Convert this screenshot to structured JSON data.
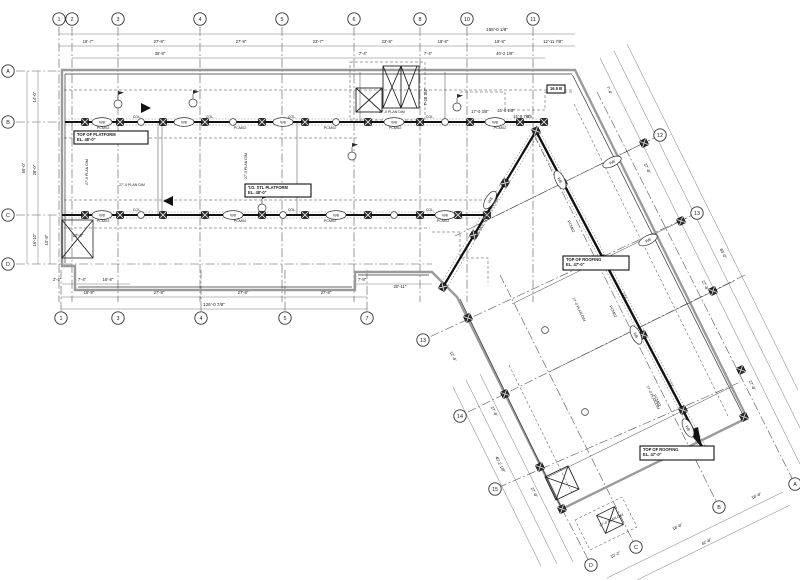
{
  "meta": {
    "drawing_type": "structural-framing-plan",
    "bg": "#ffffff",
    "ink": "#1c1c1c",
    "wall_gray": "#9a9a9a",
    "grid_line": "#555555",
    "dim_line": "#777777"
  },
  "grid": {
    "top": [
      {
        "label": "1",
        "x": 59
      },
      {
        "label": "2",
        "x": 72
      },
      {
        "label": "3",
        "x": 118
      },
      {
        "label": "4",
        "x": 200
      },
      {
        "label": "5",
        "x": 282
      },
      {
        "label": "6",
        "x": 354
      },
      {
        "label": "8",
        "x": 420
      },
      {
        "label": "10",
        "x": 467
      },
      {
        "label": "11",
        "x": 533
      }
    ],
    "bottom": [
      {
        "label": "1",
        "x": 61
      },
      {
        "label": "3",
        "x": 118
      },
      {
        "label": "4",
        "x": 201
      },
      {
        "label": "5",
        "x": 285
      },
      {
        "label": "7",
        "x": 367
      }
    ],
    "left": [
      {
        "label": "A",
        "y": 71
      },
      {
        "label": "B",
        "y": 122
      },
      {
        "label": "C",
        "y": 215
      },
      {
        "label": "D",
        "y": 264
      }
    ],
    "wing_right": [
      {
        "label": "12",
        "x": 660,
        "y": 135
      },
      {
        "label": "13",
        "x": 697,
        "y": 213
      }
    ],
    "wing_left": [
      {
        "label": "13",
        "x": 423,
        "y": 340
      },
      {
        "label": "14",
        "x": 460,
        "y": 416
      },
      {
        "label": "15",
        "x": 495,
        "y": 489
      }
    ],
    "wing_end": [
      {
        "label": "A",
        "x": 795,
        "y": 484
      },
      {
        "label": "B",
        "x": 719,
        "y": 507
      },
      {
        "label": "C",
        "x": 636,
        "y": 547
      },
      {
        "label": "D",
        "x": 591,
        "y": 565
      }
    ]
  },
  "dimensions": [
    {
      "t": "168'-0 1/8\"",
      "x": 497,
      "y": 31,
      "r": 0,
      "s": 4.6
    },
    {
      "t": "18'-7\"",
      "x": 88,
      "y": 43,
      "r": 0
    },
    {
      "t": "27'-8\"",
      "x": 159,
      "y": 43,
      "r": 0
    },
    {
      "t": "27'-8\"",
      "x": 241,
      "y": 43,
      "r": 0
    },
    {
      "t": "23'-7\"",
      "x": 318,
      "y": 43,
      "r": 0
    },
    {
      "t": "22'-8\"",
      "x": 387,
      "y": 43,
      "r": 0
    },
    {
      "t": "18'-8\"",
      "x": 443,
      "y": 43,
      "r": 0
    },
    {
      "t": "18'-8\"",
      "x": 500,
      "y": 43,
      "r": 0
    },
    {
      "t": "12'-11 7/8\"",
      "x": 553,
      "y": 43,
      "r": 0
    },
    {
      "t": "36'-8\"",
      "x": 160,
      "y": 55,
      "r": 0
    },
    {
      "t": "7'-4\"",
      "x": 363,
      "y": 55,
      "r": 0
    },
    {
      "t": "7'-4\"",
      "x": 428,
      "y": 55,
      "r": 0
    },
    {
      "t": "40'-2 1/8\"",
      "x": 505,
      "y": 55,
      "r": 0
    },
    {
      "t": "18'-8\"",
      "x": 89,
      "y": 294,
      "r": 0
    },
    {
      "t": "27'-8\"",
      "x": 159,
      "y": 294,
      "r": 0
    },
    {
      "t": "27'-8\"",
      "x": 243,
      "y": 294,
      "r": 0
    },
    {
      "t": "27'-8\"",
      "x": 326,
      "y": 294,
      "r": 0
    },
    {
      "t": "126'-0 7/8\"",
      "x": 214,
      "y": 306,
      "r": 0,
      "s": 4.6
    },
    {
      "t": "2'-4\"",
      "x": 57,
      "y": 281,
      "r": 0
    },
    {
      "t": "7'-4\"",
      "x": 82,
      "y": 281,
      "r": 0
    },
    {
      "t": "16'-8\"",
      "x": 108,
      "y": 281,
      "r": 0
    },
    {
      "t": "7'-8\"",
      "x": 362,
      "y": 281,
      "r": 0
    },
    {
      "t": "20'-11\"",
      "x": 400,
      "y": 288,
      "r": 0
    },
    {
      "t": "56'-0\"",
      "x": 25,
      "y": 168,
      "r": -90
    },
    {
      "t": "14'-0\"",
      "x": 36,
      "y": 97,
      "r": -90
    },
    {
      "t": "28'-0\"",
      "x": 36,
      "y": 170,
      "r": -90
    },
    {
      "t": "16'-10\"",
      "x": 36,
      "y": 240,
      "r": -90
    },
    {
      "t": "10'-8\"",
      "x": 48,
      "y": 240,
      "r": -90
    },
    {
      "t": "27'-8\"",
      "x": 646,
      "y": 169,
      "r": 64
    },
    {
      "t": "27'-8\"",
      "x": 704,
      "y": 286,
      "r": 64
    },
    {
      "t": "27'-8\"",
      "x": 751,
      "y": 386,
      "r": 64
    },
    {
      "t": "83'-0\"",
      "x": 722,
      "y": 254,
      "r": 64
    },
    {
      "t": "7'-4\"",
      "x": 608,
      "y": 91,
      "r": 64
    },
    {
      "t": "27'-8\"",
      "x": 493,
      "y": 412,
      "r": 64
    },
    {
      "t": "27'-8\"",
      "x": 533,
      "y": 493,
      "r": 64
    },
    {
      "t": "40'-2 1/8\"",
      "x": 499,
      "y": 465,
      "r": 64
    },
    {
      "t": "12'-4\"",
      "x": 452,
      "y": 357,
      "r": 64
    },
    {
      "t": "18'-8\"",
      "x": 757,
      "y": 497,
      "r": -26
    },
    {
      "t": "18'-8\"",
      "x": 678,
      "y": 528,
      "r": -26
    },
    {
      "t": "10'-2\"",
      "x": 616,
      "y": 556,
      "r": -26
    },
    {
      "t": "42'-8\"",
      "x": 707,
      "y": 543,
      "r": -26
    },
    {
      "t": "15'-8 1/8\"",
      "x": 506,
      "y": 112,
      "r": 0
    },
    {
      "t": "15'-8 7/8\"",
      "x": 522,
      "y": 118,
      "r": 0
    },
    {
      "t": "10'-8\"",
      "x": 78,
      "y": 237,
      "r": 0
    },
    {
      "t": "7'-10 3/4\"",
      "x": 427,
      "y": 97,
      "r": -90
    },
    {
      "t": "17'-0 3/8\"",
      "x": 480,
      "y": 113,
      "r": 0
    }
  ],
  "plan_dims": [
    {
      "t": "27'-0 PLAN DIM",
      "x": 132,
      "y": 186,
      "r": 0
    },
    {
      "t": "27'-0 PLAN DIM",
      "x": 88,
      "y": 172,
      "r": -90
    },
    {
      "t": "27'-0 PLAN DIM",
      "x": 247,
      "y": 166,
      "r": -90
    },
    {
      "t": "27'-0 PLAN DIM",
      "x": 392,
      "y": 113,
      "r": 0
    },
    {
      "t": "27'-0 PLAN DIM",
      "x": 578,
      "y": 310,
      "r": 64
    },
    {
      "t": "27'-0 PLAN DIM",
      "x": 652,
      "y": 398,
      "r": 64
    },
    {
      "t": "27'-0 PLAN DIM",
      "x": 492,
      "y": 210,
      "r": -59
    },
    {
      "t": "27'-0 PLAN DIM",
      "x": 612,
      "y": 521,
      "r": -26
    }
  ],
  "notes": [
    {
      "lines": [
        "TOP OF PLATFORM",
        "EL. 48'-0\""
      ],
      "x": 74,
      "y": 131,
      "w": 74,
      "h": 13
    },
    {
      "lines": [
        "T.O. STL PLATFORM",
        "EL. 48'-0\""
      ],
      "x": 245,
      "y": 184,
      "w": 66,
      "h": 13
    },
    {
      "lines": [
        "TOP OF ROOFING",
        "EL. 47'-0\""
      ],
      "x": 563,
      "y": 256,
      "w": 66,
      "h": 14
    },
    {
      "lines": [
        "TOP OF ROOFING",
        "EL. 47'-0\""
      ],
      "x": 640,
      "y": 446,
      "w": 74,
      "h": 14
    },
    {
      "lines": [
        "16.5 B"
      ],
      "x": 547,
      "y": 85,
      "w": 18,
      "h": 8
    }
  ],
  "beam_labels": [
    {
      "t": "PCM02",
      "x": 103,
      "y": 129,
      "r": 0
    },
    {
      "t": "PCM02",
      "x": 240,
      "y": 129,
      "r": 0
    },
    {
      "t": "PCM02",
      "x": 330,
      "y": 129,
      "r": 0
    },
    {
      "t": "PCM02",
      "x": 395,
      "y": 129,
      "r": 0
    },
    {
      "t": "PCM02",
      "x": 500,
      "y": 129,
      "r": 0
    },
    {
      "t": "PCM02",
      "x": 103,
      "y": 222,
      "r": 0
    },
    {
      "t": "PCM02",
      "x": 240,
      "y": 222,
      "r": 0
    },
    {
      "t": "PCM02",
      "x": 330,
      "y": 222,
      "r": 0
    },
    {
      "t": "PCM02",
      "x": 443,
      "y": 222,
      "r": 0
    },
    {
      "t": "PCM02",
      "x": 570,
      "y": 227,
      "r": 64
    },
    {
      "t": "PCM02",
      "x": 612,
      "y": 312,
      "r": 64
    },
    {
      "t": "PCM02",
      "x": 656,
      "y": 401,
      "r": 64
    },
    {
      "t": "PCM02",
      "x": 481,
      "y": 230,
      "r": -59
    }
  ],
  "beam_tags": [
    {
      "t": "W8",
      "x": 102,
      "y": 122,
      "r": 0
    },
    {
      "t": "W8",
      "x": 184,
      "y": 122,
      "r": 0
    },
    {
      "t": "W8",
      "x": 283,
      "y": 122,
      "r": 0
    },
    {
      "t": "W8",
      "x": 394,
      "y": 122,
      "r": 0
    },
    {
      "t": "W8",
      "x": 495,
      "y": 122,
      "r": 0
    },
    {
      "t": "W8",
      "x": 102,
      "y": 215,
      "r": 0
    },
    {
      "t": "W8",
      "x": 233,
      "y": 215,
      "r": 0
    },
    {
      "t": "W8",
      "x": 336,
      "y": 215,
      "r": 0
    },
    {
      "t": "W8",
      "x": 445,
      "y": 215,
      "r": 0
    },
    {
      "t": "W8",
      "x": 560,
      "y": 180,
      "r": 64
    },
    {
      "t": "W8",
      "x": 636,
      "y": 335,
      "r": 64
    },
    {
      "t": "W8",
      "x": 688,
      "y": 428,
      "r": 64
    },
    {
      "t": "W8",
      "x": 490,
      "y": 200,
      "r": -59
    },
    {
      "t": "W8",
      "x": 612,
      "y": 162,
      "r": -26
    },
    {
      "t": "W8",
      "x": 648,
      "y": 240,
      "r": -26
    }
  ],
  "small_circles": [
    {
      "x": 141,
      "y": 122
    },
    {
      "x": 233,
      "y": 122
    },
    {
      "x": 336,
      "y": 122
    },
    {
      "x": 445,
      "y": 122
    },
    {
      "x": 141,
      "y": 215
    },
    {
      "x": 283,
      "y": 215
    },
    {
      "x": 394,
      "y": 215
    },
    {
      "x": 545,
      "y": 330
    },
    {
      "x": 585,
      "y": 412
    }
  ],
  "col_texts": [
    {
      "t": "COL.",
      "x": 137,
      "y": 118,
      "r": 0
    },
    {
      "t": "COL.",
      "x": 210,
      "y": 118,
      "r": 0
    },
    {
      "t": "COL.",
      "x": 292,
      "y": 118,
      "r": 0
    },
    {
      "t": "COL.",
      "x": 430,
      "y": 118,
      "r": 0
    },
    {
      "t": "COL.",
      "x": 530,
      "y": 118,
      "r": 0
    },
    {
      "t": "COL.",
      "x": 137,
      "y": 211,
      "r": 0
    },
    {
      "t": "COL.",
      "x": 292,
      "y": 211,
      "r": 0
    },
    {
      "t": "COL.",
      "x": 430,
      "y": 211,
      "r": 0
    },
    {
      "t": "COL.",
      "x": 624,
      "y": 297,
      "r": 64
    },
    {
      "t": "COL.",
      "x": 670,
      "y": 385,
      "r": 64
    }
  ],
  "columns": [
    {
      "x": 85,
      "y": 122,
      "r": 0
    },
    {
      "x": 120,
      "y": 122,
      "r": 0
    },
    {
      "x": 163,
      "y": 122,
      "r": 0
    },
    {
      "x": 205,
      "y": 122,
      "r": 0
    },
    {
      "x": 262,
      "y": 122,
      "r": 0
    },
    {
      "x": 305,
      "y": 122,
      "r": 0
    },
    {
      "x": 368,
      "y": 122,
      "r": 0
    },
    {
      "x": 420,
      "y": 122,
      "r": 0
    },
    {
      "x": 470,
      "y": 122,
      "r": 0
    },
    {
      "x": 520,
      "y": 122,
      "r": 0
    },
    {
      "x": 544,
      "y": 122,
      "r": 0
    },
    {
      "x": 85,
      "y": 215,
      "r": 0
    },
    {
      "x": 120,
      "y": 215,
      "r": 0
    },
    {
      "x": 163,
      "y": 215,
      "r": 0
    },
    {
      "x": 205,
      "y": 215,
      "r": 0
    },
    {
      "x": 262,
      "y": 215,
      "r": 0
    },
    {
      "x": 305,
      "y": 215,
      "r": 0
    },
    {
      "x": 368,
      "y": 215,
      "r": 0
    },
    {
      "x": 420,
      "y": 215,
      "r": 0
    },
    {
      "x": 458,
      "y": 215,
      "r": 0
    },
    {
      "x": 487,
      "y": 215,
      "r": 0
    },
    {
      "x": 536,
      "y": 131,
      "r": 64
    },
    {
      "x": 563,
      "y": 183,
      "r": 64
    },
    {
      "x": 603,
      "y": 259,
      "r": 64
    },
    {
      "x": 643,
      "y": 335,
      "r": 64
    },
    {
      "x": 683,
      "y": 410,
      "r": 64
    },
    {
      "x": 706,
      "y": 455,
      "r": 64
    },
    {
      "x": 505,
      "y": 183,
      "r": 31
    },
    {
      "x": 474,
      "y": 235,
      "r": 31
    },
    {
      "x": 443,
      "y": 287,
      "r": 31
    },
    {
      "x": 644,
      "y": 143,
      "r": 64
    },
    {
      "x": 681,
      "y": 221,
      "r": 64
    },
    {
      "x": 713,
      "y": 291,
      "r": 64
    },
    {
      "x": 741,
      "y": 370,
      "r": 64
    },
    {
      "x": 468,
      "y": 318,
      "r": 64
    },
    {
      "x": 505,
      "y": 394,
      "r": 64
    },
    {
      "x": 540,
      "y": 467,
      "r": 64
    },
    {
      "x": 744,
      "y": 417,
      "r": 64
    },
    {
      "x": 562,
      "y": 509,
      "r": 64
    }
  ],
  "callouts": [
    {
      "x": 118,
      "y": 104
    },
    {
      "x": 193,
      "y": 103
    },
    {
      "x": 262,
      "y": 208
    },
    {
      "x": 352,
      "y": 156
    },
    {
      "x": 457,
      "y": 107
    }
  ]
}
